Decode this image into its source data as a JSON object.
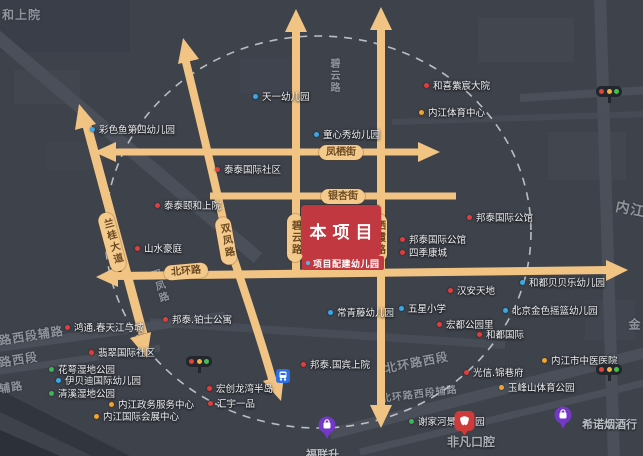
{
  "project": {
    "name": "本项目",
    "kindergarten": "项目配建幼儿园"
  },
  "road_pills": [
    {
      "label": "凤栖街",
      "x": 319,
      "y": 145,
      "vertical": false,
      "rot": 0
    },
    {
      "label": "银杏街",
      "x": 321,
      "y": 189,
      "vertical": false,
      "rot": 0
    },
    {
      "label": "北环路",
      "x": 164,
      "y": 264,
      "vertical": false,
      "rot": -5
    },
    {
      "label": "碧云路",
      "x": 287,
      "y": 214,
      "vertical": true,
      "rot": 0
    },
    {
      "label": "栖霞路",
      "x": 371,
      "y": 214,
      "vertical": true,
      "rot": 0
    },
    {
      "label": "双凤路",
      "x": 218,
      "y": 217,
      "vertical": true,
      "rot": -10
    },
    {
      "label": "兰桂大道",
      "x": 104,
      "y": 212,
      "vertical": true,
      "rot": -15
    }
  ],
  "poi_colors": {
    "school": "#3aa7e8",
    "residence": "#e23c3c",
    "park": "#3cb553",
    "public": "#f0a431"
  },
  "pois": [
    {
      "label": "天一幼儿园",
      "type": "school",
      "x": 255,
      "y": 95
    },
    {
      "label": "彩色鱼第四幼儿园",
      "type": "school",
      "x": 92,
      "y": 128
    },
    {
      "label": "童心秀幼儿园",
      "type": "school",
      "x": 316,
      "y": 133
    },
    {
      "label": "常青藤幼儿园",
      "type": "school",
      "x": 330,
      "y": 311
    },
    {
      "label": "五星小学",
      "type": "school",
      "x": 401,
      "y": 307
    },
    {
      "label": "和都贝贝乐幼儿园",
      "type": "school",
      "x": 522,
      "y": 281
    },
    {
      "label": "北京金色摇篮幼儿园",
      "type": "school",
      "x": 505,
      "y": 309
    },
    {
      "label": "伊贝迪国际幼儿园",
      "type": "school",
      "x": 58,
      "y": 379
    },
    {
      "label": "泰泰国际社区",
      "type": "residence",
      "x": 217,
      "y": 168
    },
    {
      "label": "泰泰颐和上院",
      "type": "residence",
      "x": 157,
      "y": 204
    },
    {
      "label": "和喜紫宸大院",
      "type": "residence",
      "x": 426,
      "y": 84
    },
    {
      "label": "邦泰国际公馆",
      "type": "residence",
      "x": 469,
      "y": 216
    },
    {
      "label": "邦泰国际公馆",
      "type": "residence",
      "x": 402,
      "y": 238
    },
    {
      "label": "四季康城",
      "type": "residence",
      "x": 402,
      "y": 251
    },
    {
      "label": "汉安天地",
      "type": "residence",
      "x": 450,
      "y": 289
    },
    {
      "label": "宏都公园里",
      "type": "residence",
      "x": 439,
      "y": 323
    },
    {
      "label": "和都国际",
      "type": "residence",
      "x": 479,
      "y": 333
    },
    {
      "label": "山水豪庭",
      "type": "residence",
      "x": 137,
      "y": 247
    },
    {
      "label": "邦泰.铂士公寓",
      "type": "residence",
      "x": 165,
      "y": 318
    },
    {
      "label": "宏创龙湾半岛",
      "type": "residence",
      "x": 209,
      "y": 387
    },
    {
      "label": "汇宇一品",
      "type": "residence",
      "x": 210,
      "y": 402
    },
    {
      "label": "邦泰.国宾上院",
      "type": "residence",
      "x": 303,
      "y": 363
    },
    {
      "label": "鸿通.春天江与城",
      "type": "residence",
      "x": 67,
      "y": 326
    },
    {
      "label": "翡翠国际社区",
      "type": "residence",
      "x": 91,
      "y": 351
    },
    {
      "label": "光信.锦巷府",
      "type": "residence",
      "x": 466,
      "y": 371
    },
    {
      "label": "花萼湿地公园",
      "type": "park",
      "x": 51,
      "y": 368
    },
    {
      "label": "清溪湿地公园",
      "type": "park",
      "x": 51,
      "y": 392
    },
    {
      "label": "谢家河景观公园",
      "type": "park",
      "x": 411,
      "y": 420
    },
    {
      "label": "内江体育中心",
      "type": "public",
      "x": 421,
      "y": 111
    },
    {
      "label": "内江政务服务中心",
      "type": "public",
      "x": 111,
      "y": 403
    },
    {
      "label": "内江国际会展中心",
      "type": "public",
      "x": 96,
      "y": 415
    },
    {
      "label": "内江市中医医院",
      "type": "public",
      "x": 544,
      "y": 359
    },
    {
      "label": "玉峰山体育公园",
      "type": "public",
      "x": 501,
      "y": 386
    }
  ],
  "map_texts": [
    {
      "text": "和上院",
      "x": 2,
      "y": 6,
      "size": 12,
      "rot": 0,
      "vertical": false
    },
    {
      "text": "碧云路",
      "x": 326,
      "y": 58,
      "size": 10,
      "rot": 0,
      "vertical": true
    },
    {
      "text": "双凤路",
      "x": 146,
      "y": 272,
      "size": 10,
      "rot": -18,
      "vertical": true
    },
    {
      "text": "内江",
      "x": 618,
      "y": 196,
      "size": 14,
      "rot": 12,
      "vertical": false
    },
    {
      "text": "金",
      "x": 626,
      "y": 318,
      "size": 12,
      "rot": 0,
      "vertical": true
    },
    {
      "text": "北环路西段",
      "x": 383,
      "y": 360,
      "size": 12,
      "rot": -11,
      "vertical": false
    },
    {
      "text": "北环路西段辅路",
      "x": 380,
      "y": 390,
      "size": 10,
      "rot": -7,
      "vertical": false
    },
    {
      "text": "路西段辅路",
      "x": -2,
      "y": 332,
      "size": 12,
      "rot": -9,
      "vertical": false
    },
    {
      "text": "路西段",
      "x": -2,
      "y": 354,
      "size": 12,
      "rot": -9,
      "vertical": false
    },
    {
      "text": "辅路",
      "x": -2,
      "y": 381,
      "size": 11,
      "rot": -9,
      "vertical": false
    }
  ],
  "shops": {
    "fulian": {
      "label": "福联升"
    },
    "xinuo": {
      "label": "希诺烟酒行"
    },
    "feifan": {
      "label": "非凡口腔"
    }
  },
  "palette": {
    "background": "#3e424b",
    "road_orange": "#f2c484",
    "project_red": "#c23840",
    "dashed_circle": "#d0d3d8",
    "pill_bg": "#f4c98c"
  }
}
